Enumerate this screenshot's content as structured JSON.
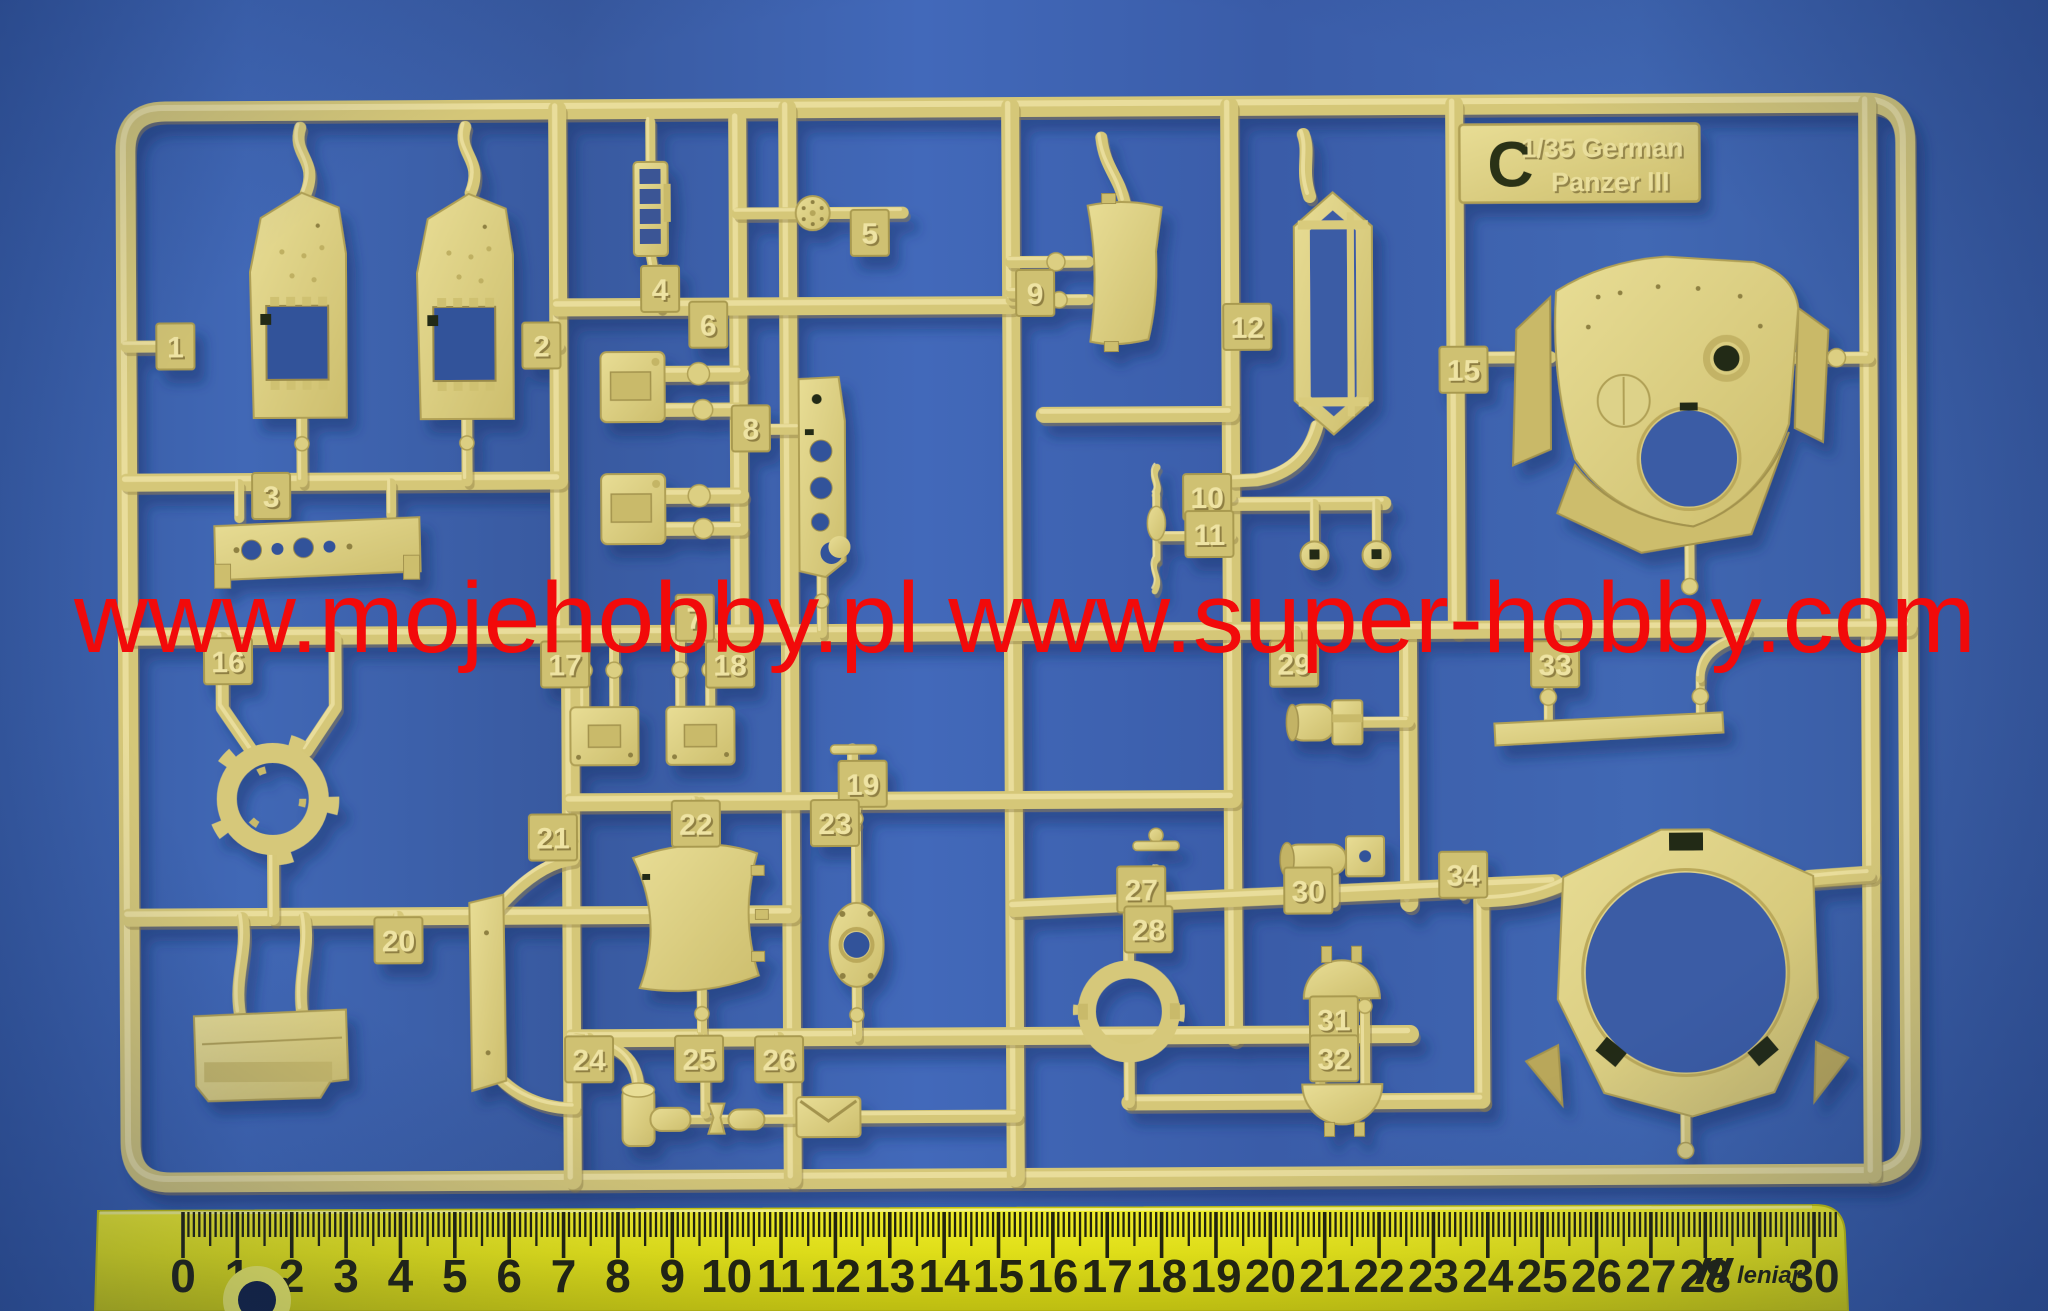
{
  "background": {
    "color": "#3d63b1"
  },
  "watermark": {
    "text": "www.mojehobby.pl www.super-hobby.com",
    "color": "#f20a0a"
  },
  "sprue": {
    "letter": "C",
    "kit_label": {
      "line1": "1/35 German",
      "line2": "Panzer III"
    },
    "plastic_color": "#d5c778",
    "tags": [
      {
        "n": "1",
        "x": 177,
        "y": 342
      },
      {
        "n": "2",
        "x": 543,
        "y": 343
      },
      {
        "n": "3",
        "x": 272,
        "y": 492
      },
      {
        "n": "4",
        "x": 662,
        "y": 287
      },
      {
        "n": "5",
        "x": 872,
        "y": 232
      },
      {
        "n": "6",
        "x": 710,
        "y": 323
      },
      {
        "n": "7",
        "x": 695,
        "y": 616
      },
      {
        "n": "8",
        "x": 752,
        "y": 427
      },
      {
        "n": "9",
        "x": 1037,
        "y": 293
      },
      {
        "n": "10",
        "x": 1208,
        "y": 498
      },
      {
        "n": "11",
        "x": 1210,
        "y": 535
      },
      {
        "n": "12",
        "x": 1249,
        "y": 328
      },
      {
        "n": "15",
        "x": 1465,
        "y": 372
      },
      {
        "n": "16",
        "x": 228,
        "y": 657
      },
      {
        "n": "17",
        "x": 565,
        "y": 662
      },
      {
        "n": "18",
        "x": 730,
        "y": 663
      },
      {
        "n": "19",
        "x": 862,
        "y": 783
      },
      {
        "n": "20",
        "x": 397,
        "y": 937
      },
      {
        "n": "21",
        "x": 552,
        "y": 835
      },
      {
        "n": "22",
        "x": 695,
        "y": 822
      },
      {
        "n": "23",
        "x": 834,
        "y": 822
      },
      {
        "n": "24",
        "x": 587,
        "y": 1057
      },
      {
        "n": "25",
        "x": 697,
        "y": 1057
      },
      {
        "n": "26",
        "x": 777,
        "y": 1058
      },
      {
        "n": "27",
        "x": 1140,
        "y": 890
      },
      {
        "n": "28",
        "x": 1147,
        "y": 930
      },
      {
        "n": "29",
        "x": 1294,
        "y": 665
      },
      {
        "n": "30",
        "x": 1307,
        "y": 892
      },
      {
        "n": "31",
        "x": 1332,
        "y": 1021
      },
      {
        "n": "32",
        "x": 1332,
        "y": 1060
      },
      {
        "n": "33",
        "x": 1555,
        "y": 667
      },
      {
        "n": "34",
        "x": 1462,
        "y": 877
      }
    ]
  },
  "ruler": {
    "labels": [
      "0",
      "1cm",
      "2",
      "3",
      "4",
      "5",
      "6",
      "7",
      "8",
      "9",
      "10",
      "11",
      "12",
      "13",
      "14",
      "15",
      "16",
      "17",
      "18",
      "19",
      "20",
      "21",
      "22",
      "23",
      "24",
      "25",
      "26",
      "27",
      "28",
      "",
      "30"
    ],
    "brand": "leniar",
    "body_color": "#efec13",
    "markings_color": "#23230a"
  }
}
